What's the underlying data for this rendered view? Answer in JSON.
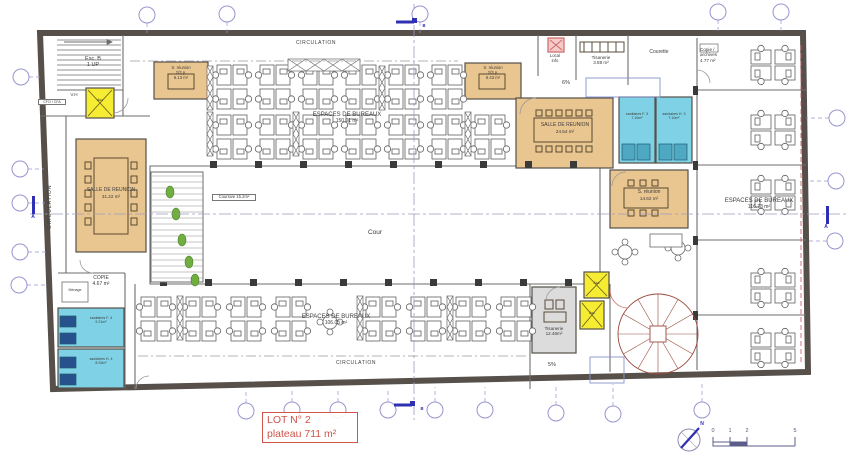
{
  "plan": {
    "lot": {
      "line1": "LOT N° 2",
      "line2": "plateau 711 m²"
    },
    "labels": {
      "circulation": "CIRCULATION",
      "cour": "Cour",
      "coursive": "Coursive 15.2m²",
      "esc_b": "Esc. B",
      "esc_b_dir": "1 UP",
      "vh": "V.H",
      "cfo_cfa": "CFO / CFA",
      "ramp_top": "6%",
      "ramp_bottom": "5%",
      "north": "N",
      "asc": "Asc"
    },
    "rooms": {
      "s_reunion_a": {
        "name": "S. réunion",
        "capacity": "2/3 p.",
        "area": "6.13 m²"
      },
      "s_reunion_b": {
        "name": "S. réunion",
        "capacity": "2/3 p.",
        "area": "6.43 m²"
      },
      "salle_reunion_a": {
        "name": "SALLE DE REUNION",
        "area": "24.54 m²"
      },
      "salle_reunion_b": {
        "name": "SALLE DE REUNION",
        "area": "31.22 m²"
      },
      "s_reunion_c": {
        "name": "S. réunion",
        "area": "14.62 m²"
      },
      "espaces_top": {
        "name": "ESPACES DE BUREAUX",
        "area": "150.01 m²"
      },
      "espaces_bottom": {
        "name": "ESPACES DE BUREAUX",
        "area": "106.05 m²"
      },
      "espaces_right": {
        "name": "ESPACES DE BUREAUX",
        "area": "116.73 m²"
      },
      "sanitaires_f3": {
        "name": "sanitaires F. 3",
        "area": "7.10m²"
      },
      "sanitaires_h3": {
        "name": "sanitaires H. 3",
        "area": "7.10m²"
      },
      "sanitaires_f4": {
        "name": "sanitaires F. 4",
        "area": "9.21m²"
      },
      "sanitaires_h4": {
        "name": "sanitaires H. 4",
        "area": "8.93m²"
      },
      "tisanerie_top": {
        "name": "Tisanerie",
        "area": "3.88 m²"
      },
      "tisanerie_bottom": {
        "name": "Tisanerie",
        "area": "12.46m²"
      },
      "courette": {
        "name": "Courette"
      },
      "copie_archives": {
        "name": "Copie /",
        "name2": "archives",
        "area": "4.77 m²"
      },
      "copie": {
        "name": "COPIE",
        "area": "4.67 m²"
      },
      "menage": {
        "name": "Ménage"
      },
      "local_info": {
        "line1": "Local",
        "line2": "info"
      }
    },
    "sections": {
      "a": "A",
      "b": "B"
    },
    "scale": {
      "t0": "0",
      "t1": "1",
      "t2": "2",
      "t3": "5"
    },
    "colors": {
      "meeting_room": "#e9c58f",
      "sanitaires": "#7fd2e6",
      "elevator": "#f6ec32",
      "tisanerie_gray": "#dcdcdc",
      "lot_red": "#d0544a",
      "grid_blue": "#9795cf",
      "section_blue": "#2f2fb3",
      "wall": "#57504a",
      "plant_green": "#6fae3f",
      "spiral_stair": "#9c4a3c"
    }
  }
}
